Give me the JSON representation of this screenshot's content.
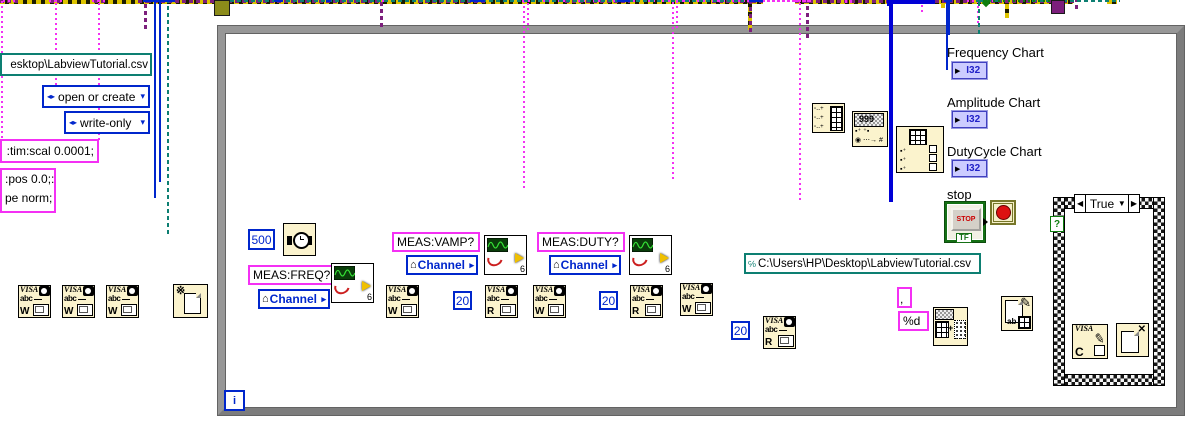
{
  "constants": {
    "path_outside": "esktop\\LabviewTutorial.csv",
    "open_mode": "open or create",
    "access_mode": "write-only",
    "scpi_timebase": ":tim:scal 0.0001;",
    "scpi_offset_line1": ":pos 0.0;:",
    "scpi_offset_line2": "pe norm;",
    "wait_ms": "500",
    "read_count_1": "20",
    "read_count_2": "20",
    "read_count_3": "20",
    "csv_path": "C:\\Users\\HP\\Desktop\\LabviewTutorial.csv",
    "delimiter": ",",
    "format_string": "%d"
  },
  "queries": {
    "freq": "MEAS:FREQ?",
    "vamp": "MEAS:VAMP?",
    "duty": "MEAS:DUTY?",
    "channel": "Channel"
  },
  "indicators": {
    "freq_label": "Frequency Chart",
    "amp_label": "Amplitude Chart",
    "duty_label": "DutyCycle Chart",
    "type": "I32"
  },
  "stop": {
    "label": "stop",
    "button": "STOP",
    "tf": "TF"
  },
  "case": {
    "selector": "True",
    "selector_left": "◀",
    "selector_right": "▶",
    "selector_down": "▼",
    "question": "?"
  },
  "loop": {
    "iterator": "i"
  },
  "icons": {
    "visa": "VISA",
    "abc": "abc",
    "write": "W",
    "read": "R",
    "close_c": "C",
    "nine": "999",
    "dots_row": "▪⁺ ⁺▪",
    "hash_row": "◉ ⋯→ #",
    "six": "6",
    "ab": "ab",
    "burst": "※",
    "x_mark": "✕",
    "home": "⌂",
    "io_arrow": "▸",
    "enum_glyph": "◂▸",
    "dropdown": "▾",
    "path_glyph": "℅",
    "plus": "+",
    "row_glyph": "▫‥+",
    "cell_glyph": "▪⁺",
    "term_arrow": "▶",
    "pencil": "✎"
  },
  "colors": {
    "string_pink": "#f430f4",
    "numeric_blue": "#0026cc",
    "path_teal": "#0d7f72",
    "visa_purple": "#7c1f7c",
    "error_yellow": "#ddc400",
    "bool_green": "#0e7e0e",
    "node_bg": "#fbf3cd",
    "loop_gray": "#8a8a8a",
    "i32_lavender": "#ccccff"
  }
}
